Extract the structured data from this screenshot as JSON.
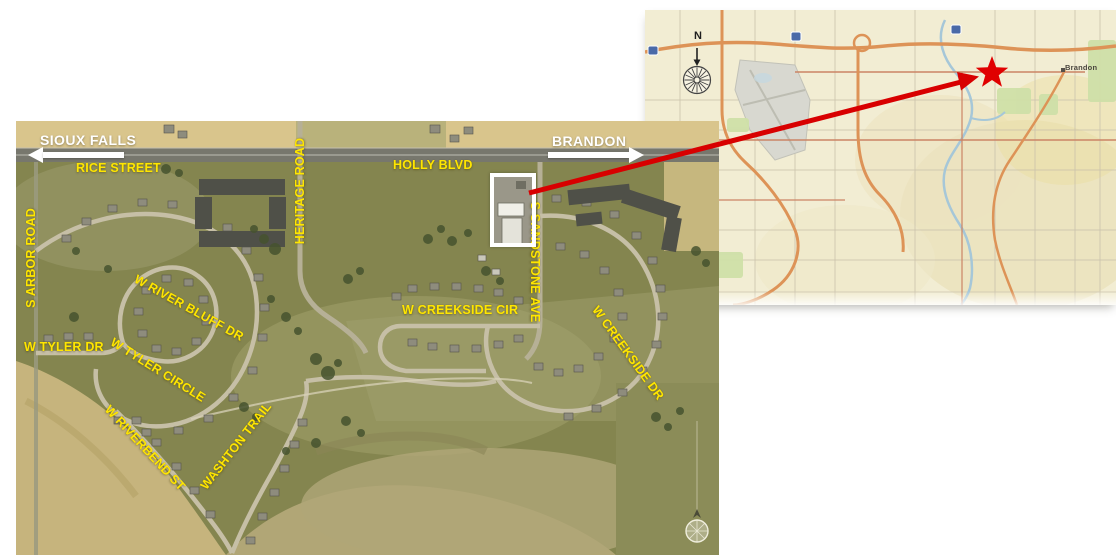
{
  "aerial": {
    "directions": {
      "west": {
        "label": "SIOUX FALLS",
        "arrow": "left"
      },
      "east": {
        "label": "BRANDON",
        "arrow": "right"
      }
    },
    "streets": {
      "rice": "RICE STREET",
      "holly": "HOLLY BLVD",
      "heritage": "HERITAGE ROAD",
      "arbor": "S ARBOR ROAD",
      "sandstone": "S SANDSTONE AVE",
      "river_bluff": "W RIVER BLUFF DR",
      "tyler_dr": "W TYLER DR",
      "tyler_circle": "W TYLER CIRCLE",
      "riverbend": "W RIVERBEND ST",
      "washton": "WASHTON TRAIL",
      "creekside_cir": "W CREEKSIDE CIR",
      "creekside_dr": "W CREEKSIDE DR"
    }
  },
  "inset": {
    "compass_north": "N",
    "city": "Brandon"
  },
  "colors": {
    "street_label": "#ffe600",
    "direction_label": "#ffffff",
    "callout_red": "#d80000",
    "highlight_box": "#ffffff",
    "inset_background": "#f2edd3",
    "aerial_base": "#84854f"
  }
}
